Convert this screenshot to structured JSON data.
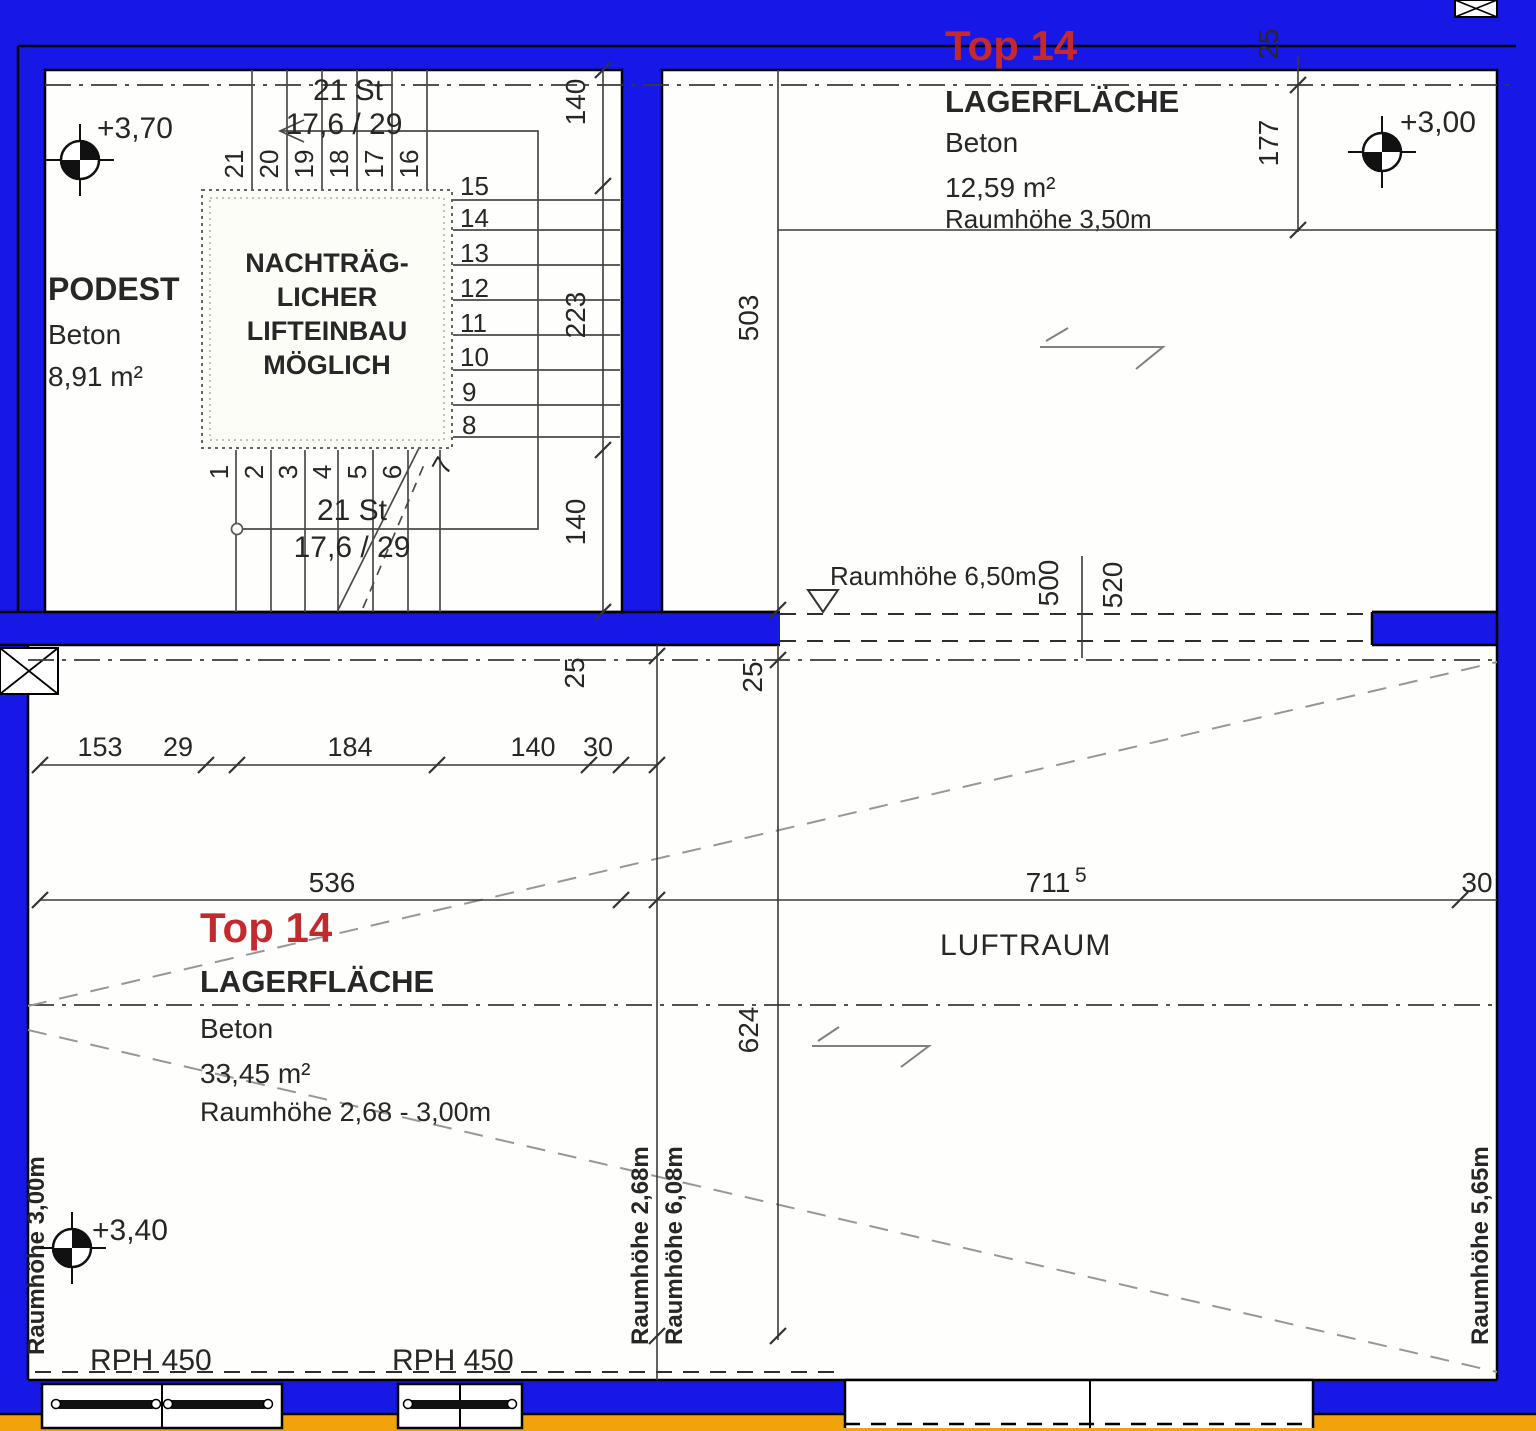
{
  "colors": {
    "wall_blue": "#1717E6",
    "base_orange": "#F2A30B",
    "title_red": "#C32A2E"
  },
  "stairwell": {
    "podest": "PODEST",
    "material": "Beton",
    "area": "8,91 m²",
    "level": "+3,70",
    "flight_label_top": "21 St",
    "riser_tread_top": "17,6 / 29",
    "flight_label_bottom": "21 St",
    "riser_tread_bottom": "17,6 / 29",
    "lift_note": [
      "NACHTRÄG-",
      "LICHER",
      "LIFTEINBAU",
      "MÖGLICH"
    ],
    "steps_top": [
      "21",
      "20",
      "19",
      "18",
      "17",
      "16"
    ],
    "steps_right": [
      "15",
      "14",
      "13",
      "12",
      "11",
      "10",
      "9",
      "8"
    ],
    "steps_bottom": [
      "1",
      "2",
      "3",
      "4",
      "5",
      "6",
      "7"
    ],
    "dim_top": "140",
    "dim_mid": "223",
    "dim_bottom": "140"
  },
  "room_top": {
    "title": "Top 14",
    "use": "LAGERFLÄCHE",
    "material": "Beton",
    "area": "12,59 m²",
    "room_height": "Raumhöhe 3,50m",
    "level": "+3,00",
    "dim_25": "25",
    "dim_177": "177",
    "dim_503": "503",
    "dim_500": "500",
    "dim_520": "520",
    "open_height": "Raumhöhe 6,50m"
  },
  "room_bottom": {
    "title": "Top 14",
    "use": "LAGERFLÄCHE",
    "material": "Beton",
    "area": "33,45 m²",
    "room_height": "Raumhöhe 2,68 - 3,00m",
    "level": "+3,40",
    "left_height": "Raumhöhe 3,00m",
    "rph_left": "RPH 450",
    "rph_right": "RPH 450",
    "chain": [
      "153",
      "29",
      "184",
      "140",
      "30"
    ],
    "dim_536": "536",
    "dim_25a": "25",
    "dim_25b": "25"
  },
  "luftraum": {
    "label": "LUFTRAUM",
    "dim_711": "711",
    "dim_711_sup": "5",
    "dim_30": "30",
    "dim_624": "624",
    "height_a": "Raumhöhe 2,68m",
    "height_b": "Raumhöhe 6,08m",
    "height_c": "Raumhöhe 5,65m"
  }
}
